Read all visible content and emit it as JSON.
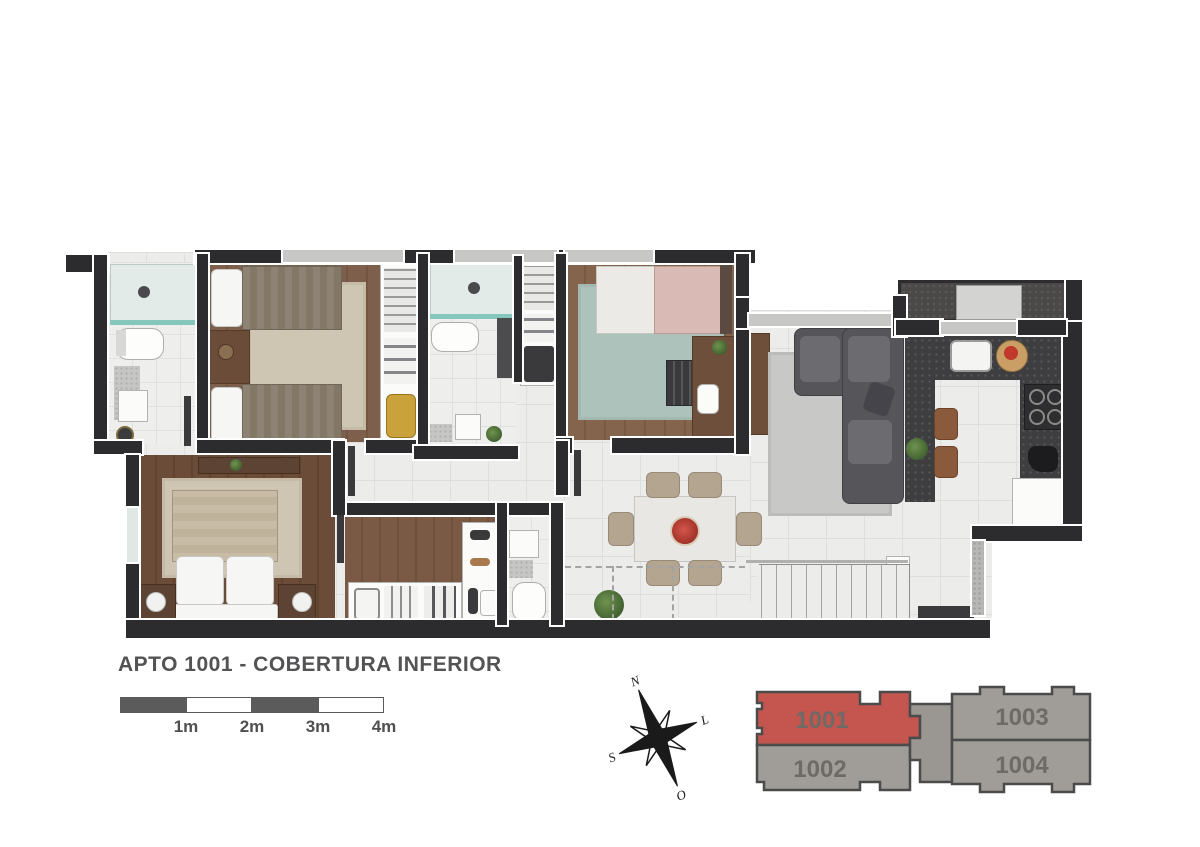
{
  "title": "APTO 1001 - COBERTURA INFERIOR",
  "scale_bar": {
    "labels": [
      "1m",
      "2m",
      "3m",
      "4m"
    ]
  },
  "compass": {
    "north": "N",
    "east": "L",
    "south": "S",
    "west": "O"
  },
  "key_plan": {
    "units": [
      {
        "label": "1001",
        "highlighted": true
      },
      {
        "label": "1002",
        "highlighted": false
      },
      {
        "label": "1003",
        "highlighted": false
      },
      {
        "label": "1004",
        "highlighted": false
      }
    ],
    "highlight_color": "#c4564f",
    "unit_color": "#a09d99",
    "outline_color": "#4b4b4b",
    "label_color": "#6e6a66"
  },
  "colors": {
    "wall": "#2c2c2e",
    "tile_floor": "#ececea",
    "wood_floor": "#7b5c47",
    "kitchen_counter": "#3e3e40",
    "shower_glass": "#86c7bd",
    "rug_beige": "#cfc5b3",
    "rug_teal": "#adc2ba",
    "title_text": "#535355"
  }
}
